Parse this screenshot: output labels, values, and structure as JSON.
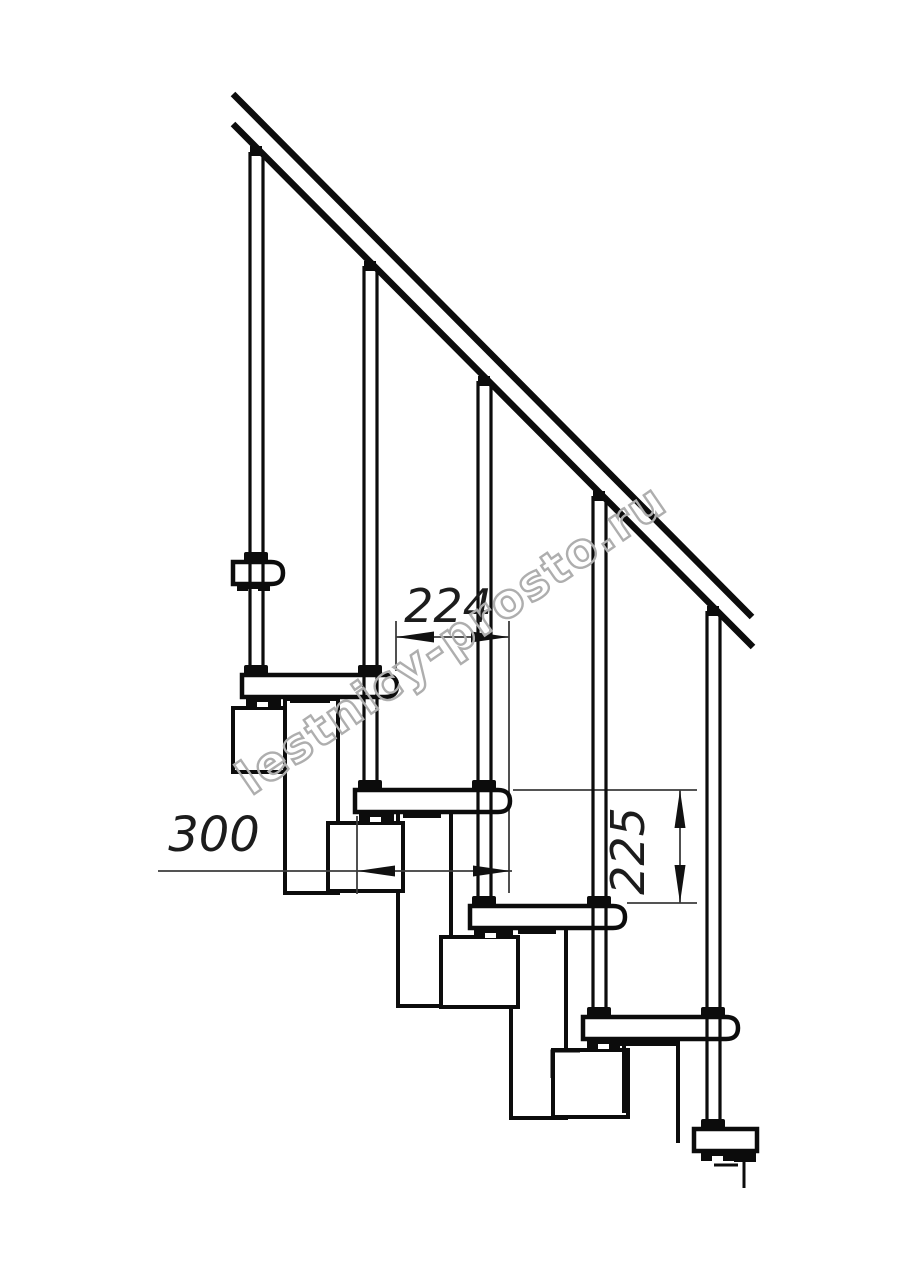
{
  "drawing": {
    "kind": "modular staircase side-view technical drawing",
    "watermark": "lestnicy-prosto.ru",
    "dimensions": {
      "tread_spacing": "224",
      "module_depth": "300",
      "step_rise": "225"
    },
    "structure": {
      "treads_visible": 6,
      "balusters_visible": 5,
      "line_color": "#0c0c0c",
      "dimension_line_color": "#3c3c3c",
      "watermark_color": "#aeaeae"
    }
  }
}
